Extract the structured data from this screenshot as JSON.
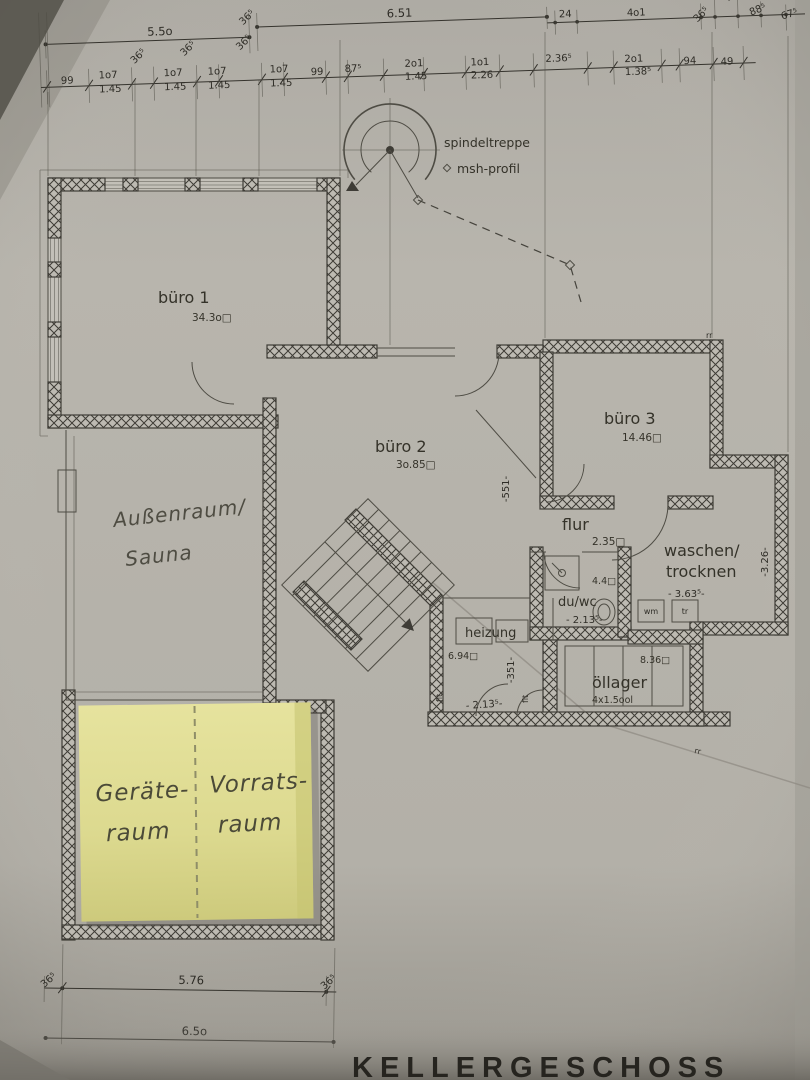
{
  "title": "KELLERGESCHOSS",
  "colors": {
    "paper": "#b4b1aa",
    "ink": "#3e3c36",
    "sticky_note": "#dcd98f"
  },
  "stair_annotations": {
    "spindeltreppe": "spindeltreppe",
    "msh_profil": "msh-profil"
  },
  "rooms": {
    "buero1": {
      "name": "büro 1",
      "area": "34.3o□"
    },
    "buero2": {
      "name": "büro 2",
      "area": "3o.85□"
    },
    "buero3": {
      "name": "büro 3",
      "area": "14.46□"
    },
    "flur": {
      "name": "flur",
      "area": "2.35□"
    },
    "waschen_trocknen": {
      "name_line1": "waschen/",
      "name_line2": "trocknen",
      "width_dim": "- 3.63⁵-"
    },
    "du_wc": {
      "name": "du/wc",
      "area": "4.4□",
      "width_dim": "- 2.13⁵-"
    },
    "heizung": {
      "name": "heizung",
      "area": "6.94□",
      "width_dim": "- 2.13⁵-"
    },
    "oellager": {
      "name": "öllager",
      "area": "8.36□",
      "tank_label": "4x1.5ool"
    },
    "appliances": {
      "wm": "wm",
      "tr": "tr"
    }
  },
  "handwritten": {
    "outdoor_room_line1": "Außenraum/",
    "outdoor_room_line2": "Sauna",
    "note_left_line1": "Geräte-",
    "note_left_line2": "raum",
    "note_right_line1": "Vorrats-",
    "note_right_line2": "raum"
  },
  "dims_top_row1": [
    {
      "t": "5.5o"
    },
    {
      "t": "6.51"
    },
    {
      "t": "24"
    },
    {
      "t": "4o1"
    },
    {
      "t": "88⁵"
    },
    {
      "t": "67⁵"
    }
  ],
  "dims_top_diag": [
    {
      "t": "36⁵"
    },
    {
      "t": "36⁵"
    },
    {
      "t": "36⁵"
    },
    {
      "t": "36⁵"
    },
    {
      "t": "36⁵"
    },
    {
      "t": "31⁵"
    }
  ],
  "dims_top_row2": [
    {
      "t": "99"
    },
    {
      "t": "1o7",
      "b": "1.45"
    },
    {
      "t": "1o7",
      "b": "1.45"
    },
    {
      "t": "1o7",
      "b": "1.45"
    },
    {
      "t": "1o7",
      "b": "1.45"
    },
    {
      "t": "99"
    },
    {
      "t": "87⁵"
    },
    {
      "t": "2o1",
      "b": "1.45"
    },
    {
      "t": "1o1",
      "b": "2.26"
    },
    {
      "t": "2.36⁵"
    },
    {
      "t": "2o1",
      "b": "1.38⁵"
    },
    {
      "t": "94"
    },
    {
      "t": "49"
    }
  ],
  "dims_vertical": [
    {
      "t": "-551-"
    },
    {
      "t": "-3.26-"
    },
    {
      "t": "-351-"
    }
  ],
  "dims_bottom": {
    "left_365": "36⁵",
    "width_576": "5.76",
    "right_365": "36⁵",
    "total_650": "6.5o"
  },
  "tiny_labels": {
    "rr_top": "rr",
    "rr_bottom": "rr",
    "flt_left": "flt",
    "flt_right": "flt"
  }
}
